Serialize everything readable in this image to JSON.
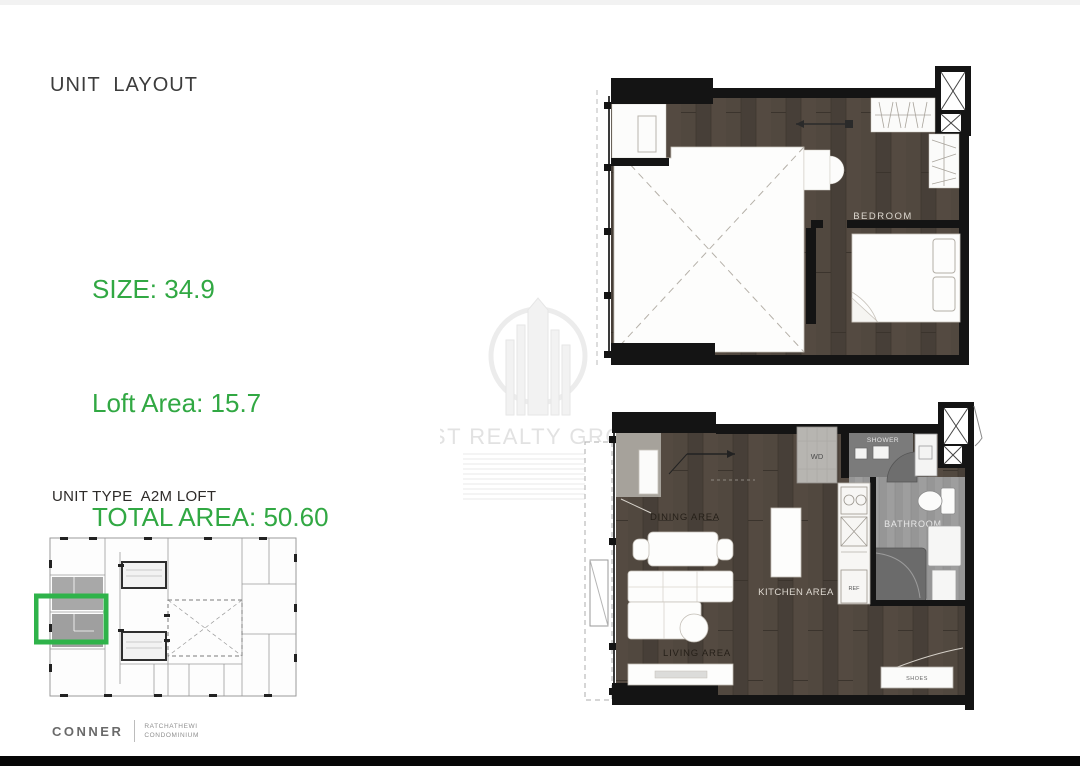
{
  "header": {
    "title": "UNIT  LAYOUT"
  },
  "stats": {
    "size": "SIZE: 34.9",
    "loft_area": "Loft Area: 15.7",
    "total_area": "TOTAL AREA: 50.60"
  },
  "unit": {
    "type_line": "UNIT TYPE  A2M LOFT",
    "bedroom_line": "1- BEDROOM"
  },
  "brand": {
    "name": "CONNER",
    "project_line1": "RATCHATHEWI",
    "project_line2": "CONDOMINIUM"
  },
  "watermark": {
    "text": "JST REALTY GROUP"
  },
  "loft_plan": {
    "labels": {
      "bedroom": "BEDROOM"
    }
  },
  "main_plan": {
    "labels": {
      "dining": "DINING AREA",
      "living": "LIVING AREA",
      "kitchen": "KITCHEN AREA",
      "bathroom": "BATHROOM",
      "shower": "SHOWER",
      "washer": "WD",
      "fridge": "REF",
      "shoes": "SHOES"
    }
  },
  "colors": {
    "accent_green": "#31a843",
    "highlight_green": "#2fb34a",
    "wall_black": "#141414",
    "wood_brown": "#4d453d",
    "bathroom_gray": "#969696",
    "title_gray": "#3c3c3c",
    "watermark_gray": "#e6e6e6"
  }
}
